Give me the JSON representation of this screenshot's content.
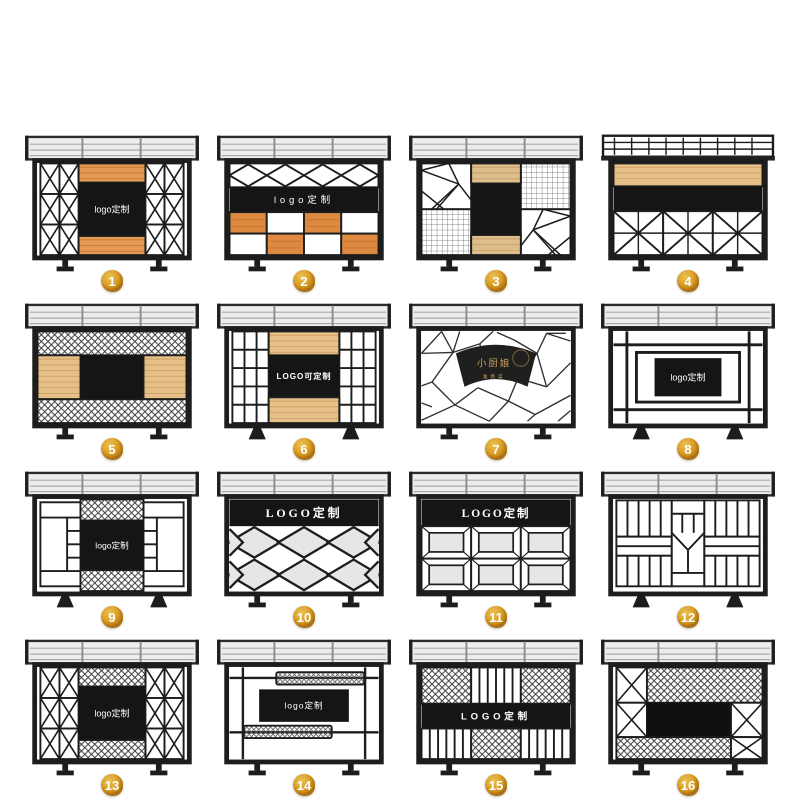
{
  "page": {
    "background": "#ffffff"
  },
  "colors": {
    "frame": "#1d1d1d",
    "black_panel": "#151515",
    "slat_fill": "#ededed",
    "slat_line": "#a8a8a8",
    "wood_orange": "#e49a52",
    "wood_orange_line": "#c87b33",
    "wood_light": "#dfbe8d",
    "wood_light_line": "#c7a369",
    "wood_tan": "#e7c089",
    "wood_tan_line": "#cda266",
    "checker_orange": "#dd8a40",
    "checker_orange_line": "#c9732f",
    "panel_gray": "#e6e6e6",
    "mesh_line": "#3a3a3a",
    "badge_gold": "#d79a23",
    "badge_text": "#ffffff",
    "label_white": "#ffffff",
    "fan_gold": "#c8a05f"
  },
  "items": [
    {
      "number": "1",
      "design": "x-columns-wood",
      "label": "logo定制",
      "top": "slats"
    },
    {
      "number": "2",
      "design": "diamond-band-checker",
      "label": "logo定制",
      "top": "slats"
    },
    {
      "number": "3",
      "design": "geo-grid-wood",
      "label": "",
      "top": "slats"
    },
    {
      "number": "4",
      "design": "railing-wood-x",
      "label": "",
      "top": "railing"
    },
    {
      "number": "5",
      "design": "mesh-wood-center",
      "label": "",
      "top": "slats"
    },
    {
      "number": "6",
      "design": "pane-columns-wood",
      "label": "LOGO可定制",
      "top": "slats"
    },
    {
      "number": "7",
      "design": "cracked-ice-fan",
      "label": "小厨娘",
      "sublabel": "淮扬菜",
      "top": "slats"
    },
    {
      "number": "8",
      "design": "nested-frames",
      "label": "logo定制",
      "top": "slats"
    },
    {
      "number": "9",
      "design": "panel-sides-mesh-center",
      "label": "logo定制",
      "top": "slats"
    },
    {
      "number": "10",
      "design": "diamond-lattice",
      "label": "LOGO定制",
      "top": "slats"
    },
    {
      "number": "11",
      "design": "bevel-panels",
      "label": "LOGO定制",
      "top": "slats"
    },
    {
      "number": "12",
      "design": "slat-grid-geo",
      "label": "",
      "top": "slats"
    },
    {
      "number": "13",
      "design": "x-columns-mesh",
      "label": "logo定制",
      "top": "slats"
    },
    {
      "number": "14",
      "design": "rails-mesh-bars",
      "label": "logo定制",
      "top": "slats"
    },
    {
      "number": "15",
      "design": "mesh-bar-band",
      "label": "LOGO定制",
      "top": "slats"
    },
    {
      "number": "16",
      "design": "mesh-triangle-black",
      "label": "",
      "top": "slats"
    }
  ]
}
